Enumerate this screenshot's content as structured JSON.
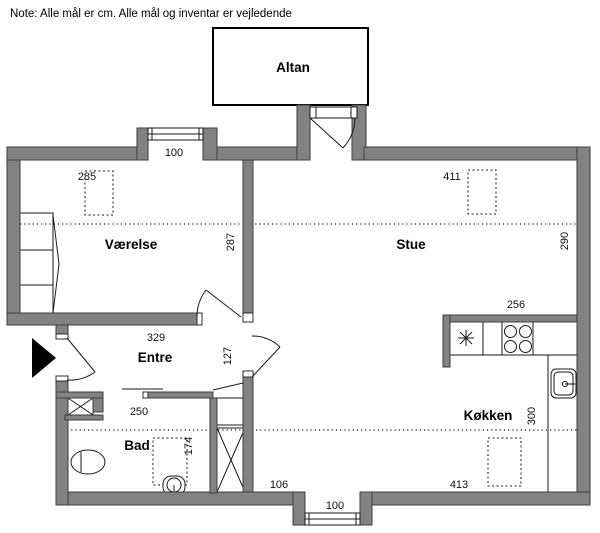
{
  "note": "Note: Alle mål er cm. Alle mål og inventar er vejledende",
  "rooms": {
    "altan": "Altan",
    "vaerelse": "Værelse",
    "stue": "Stue",
    "entre": "Entre",
    "bad": "Bad",
    "koekken": "Køkken"
  },
  "dims": {
    "vaerelse_window": "100",
    "vaerelse_bed": "285",
    "vaerelse_width": "329",
    "vaerelse_depth": "287",
    "stue_furniture": "411",
    "stue_depth": "290",
    "kitchen_counter": "256",
    "entre_opening": "127",
    "bad_width": "250",
    "bad_inner": "174",
    "koekken_depth": "300",
    "koekken_left": "106",
    "koekken_furniture": "413",
    "koekken_window": "100"
  },
  "colors": {
    "wall": "#828282",
    "wall_outline": "#3e3e3e",
    "line": "#1a1a1a"
  }
}
